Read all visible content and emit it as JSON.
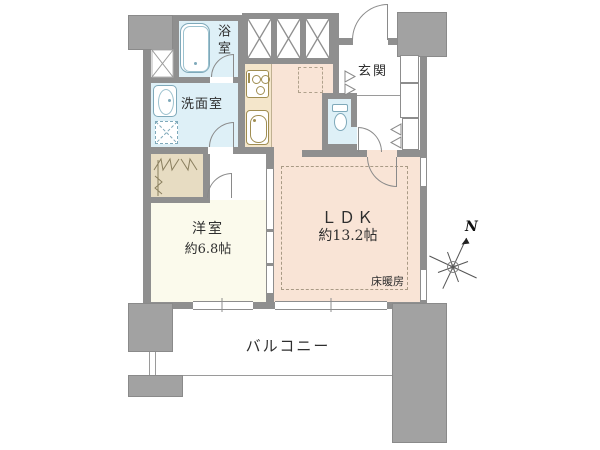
{
  "plan_title": "1LDK apartment floor plan",
  "rooms": {
    "bath": {
      "name": "浴室"
    },
    "washroom": {
      "name": "洗面室"
    },
    "entrance": {
      "name": "玄関"
    },
    "toilet": {
      "name": ""
    },
    "ldk": {
      "name": "ＬＤＫ",
      "size": "約13.2帖",
      "floor_heating": "床暖房"
    },
    "western": {
      "name": "洋室",
      "size": "約6.8帖"
    },
    "balcony": {
      "name": "バルコニー"
    }
  },
  "compass": {
    "north": "N"
  },
  "colors": {
    "wall": "#8f8f8f",
    "pillar": "#a2a2a2",
    "wet_area_floor": "#def0f7",
    "ldk_floor": "#f9e4d6",
    "western_room_floor": "#fbfaec",
    "closet": "#e7dcc2",
    "kitchen_counter": "#f4e6cb",
    "fixture_outline": "#7fa9ba"
  }
}
